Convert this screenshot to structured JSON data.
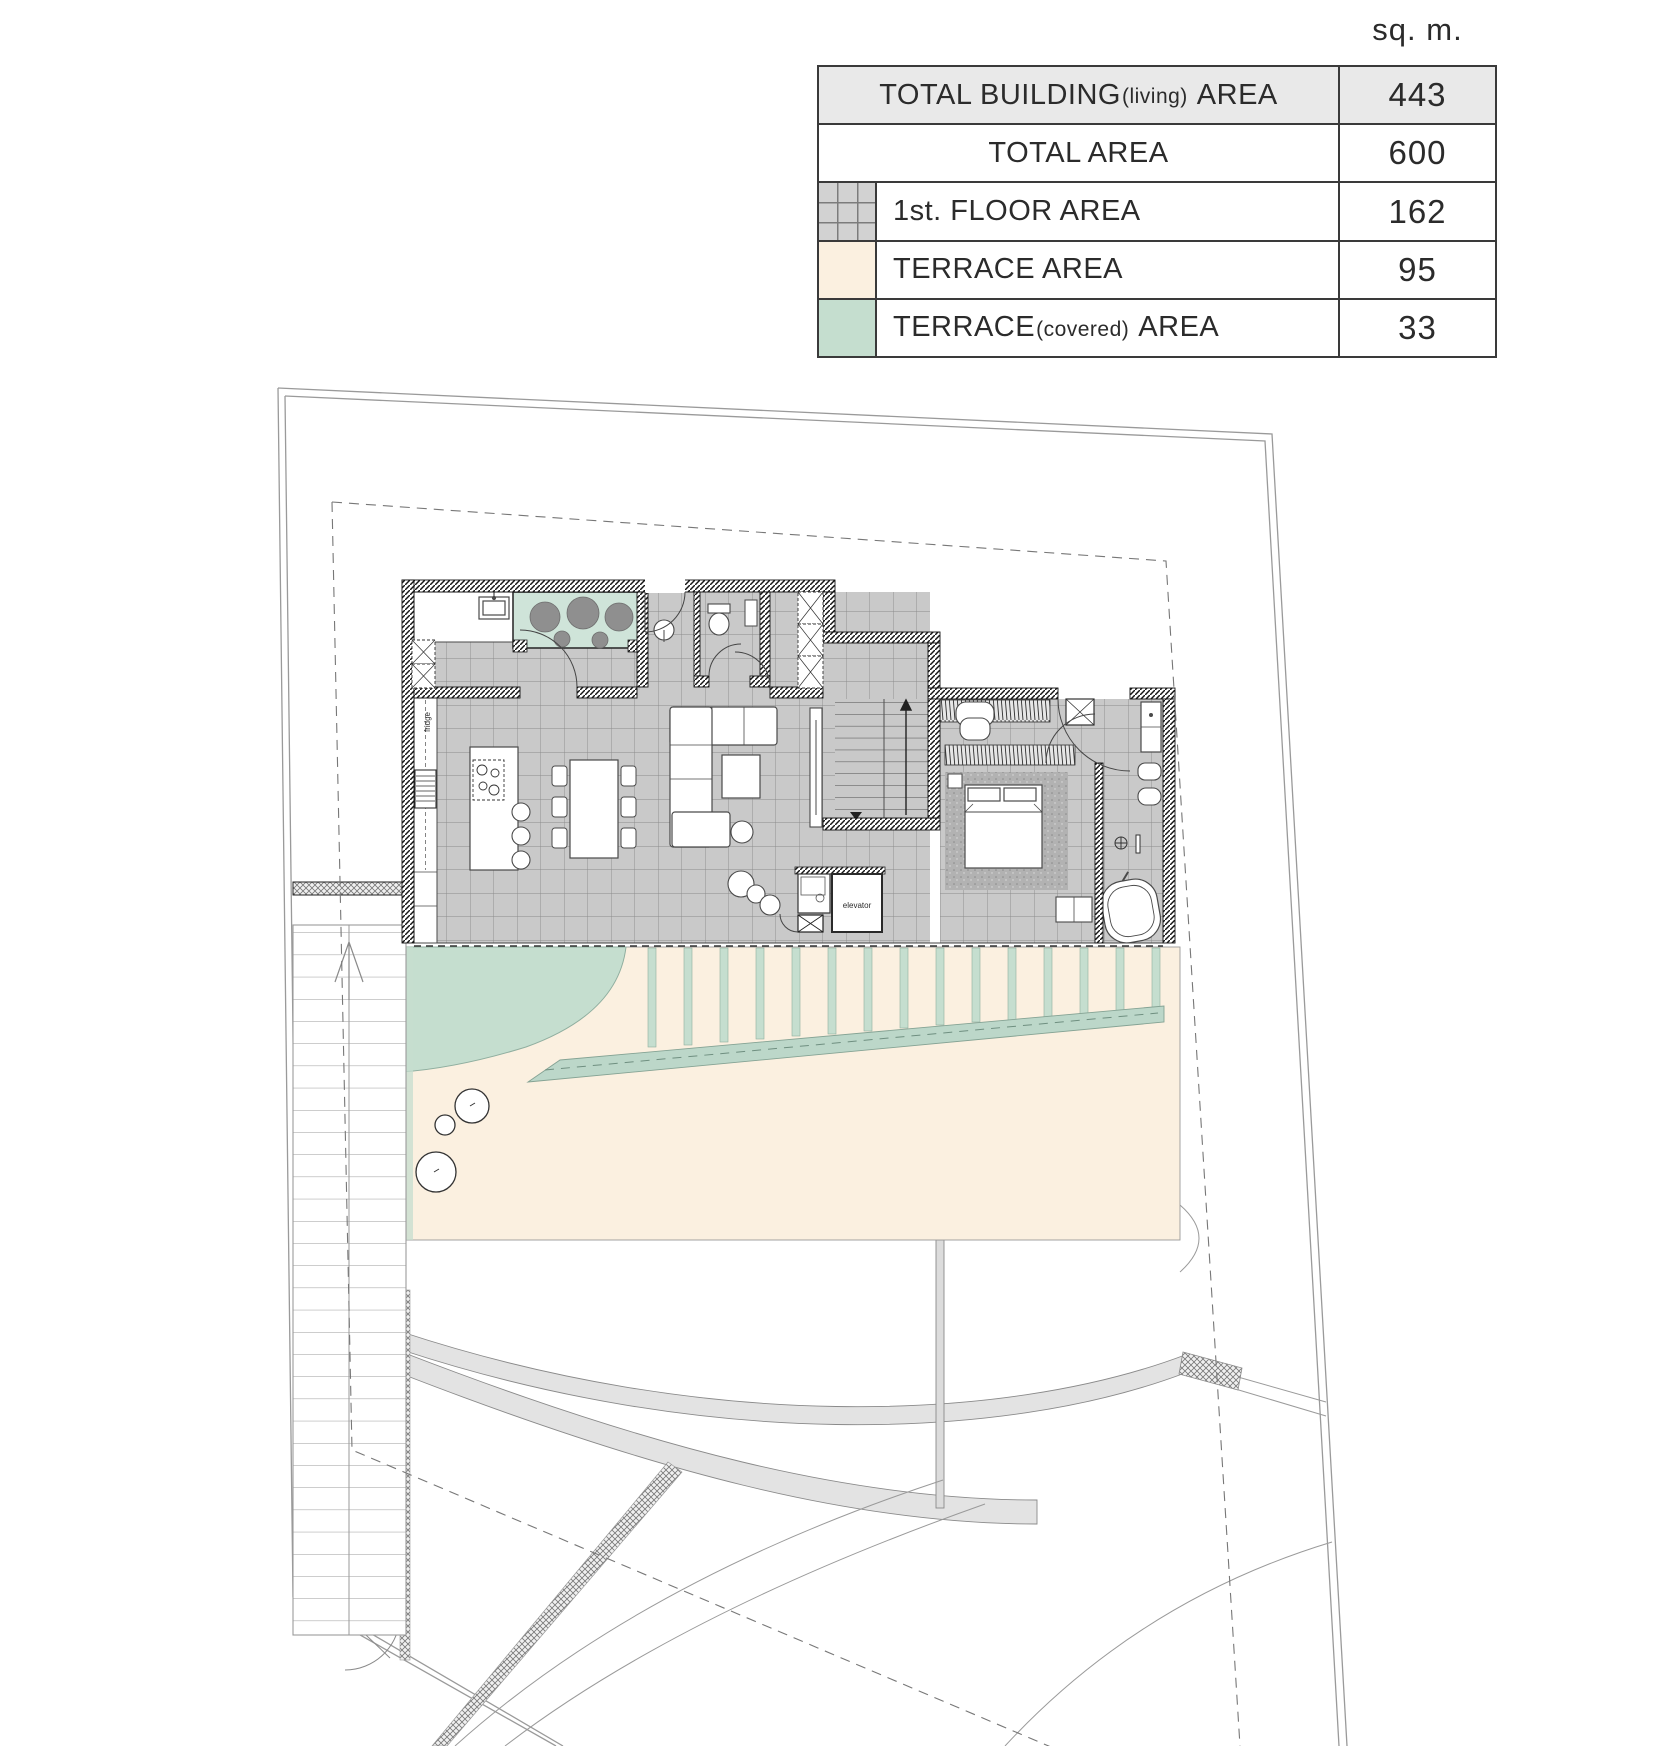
{
  "drawing": {
    "type": "architectural-floor-plan",
    "floor": "1st floor plan with site plan"
  },
  "legend": {
    "unit_label": "sq. m.",
    "rows": [
      {
        "label": "TOTAL BUILDING",
        "label_paren": "(living)",
        "label_suffix": "AREA",
        "value": "443",
        "swatch": "none",
        "header": true
      },
      {
        "label": "TOTAL AREA",
        "label_paren": "",
        "label_suffix": "",
        "value": "600",
        "swatch": "none",
        "header": false
      },
      {
        "label": "1st. FLOOR AREA",
        "label_paren": "",
        "label_suffix": "",
        "value": "162",
        "swatch": "floor-tile",
        "header": false
      },
      {
        "label": "TERRACE AREA",
        "label_paren": "",
        "label_suffix": "",
        "value": "95",
        "swatch": "terrace",
        "header": false
      },
      {
        "label": "TERRACE",
        "label_paren": "(covered)",
        "label_suffix": "AREA",
        "value": "33",
        "swatch": "terrace-covered",
        "header": false
      }
    ]
  },
  "plan_labels": {
    "fridge": "fridge",
    "elevator": "elevator"
  },
  "colors": {
    "header_row": "#e9e9e9",
    "terrace": "#fbf0e0",
    "terrace_covered": "#c5decf",
    "floor_tile": "#c9c9c9",
    "walkway_band": "#bcd7c9",
    "wall": "#1a1a1a",
    "boundary": "#9a9a9a"
  }
}
